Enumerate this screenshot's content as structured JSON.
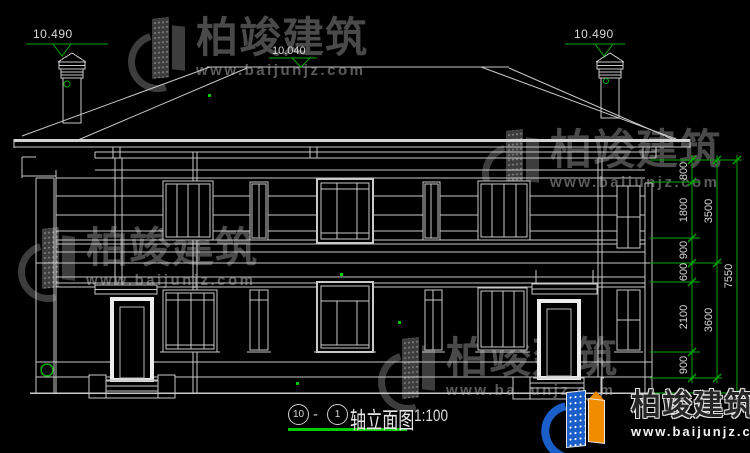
{
  "drawing": {
    "elevation_markers": {
      "left_chimney": "10.490",
      "ridge": "10.040",
      "right_chimney": "10.490"
    },
    "dimension_chain": {
      "segments": [
        "800",
        "1800",
        "900",
        "600",
        "2100",
        "900"
      ],
      "subtotals": [
        "3500",
        "3600"
      ],
      "total": "7550"
    },
    "title": {
      "axis_from": "10",
      "separator": "-",
      "axis_to": "1",
      "label": "轴立面图",
      "scale": "1:100"
    }
  },
  "watermark": {
    "brand": "柏竣建筑",
    "website": "www.baijunjz.com"
  },
  "logo": {
    "brand": "柏竣建筑",
    "website": "www.baijunjz.com"
  },
  "colors": {
    "background": "#000000",
    "linework": "#c9c9c9",
    "bright_frame": "#ededed",
    "dimension_green": "#00a800",
    "underline_green": "#00cc00",
    "logo_blue": "#1a5ec9",
    "logo_orange": "#f08c00"
  }
}
